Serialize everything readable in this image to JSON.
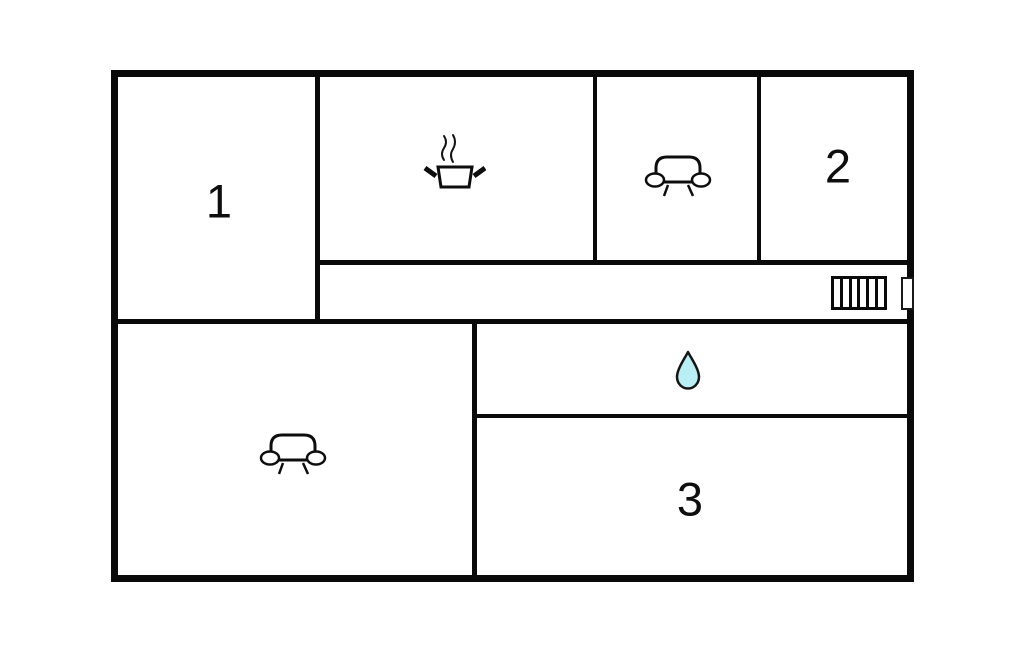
{
  "document": {
    "type": "floor-plan"
  },
  "colors": {
    "background": "#ffffff",
    "wall": "#0a0a0a",
    "water_drop_fill": "#b9eef4"
  },
  "rooms": {
    "room1": {
      "label": "1"
    },
    "room2": {
      "label": "2"
    },
    "room3": {
      "label": "3"
    }
  },
  "icons": {
    "kitchen": "cooking-pot-icon",
    "top_lounge": "sofa-icon",
    "living_room": "sofa-icon",
    "bathroom": "water-drop-icon",
    "hallway": "stairs-icon",
    "entrance": "door-icon"
  }
}
